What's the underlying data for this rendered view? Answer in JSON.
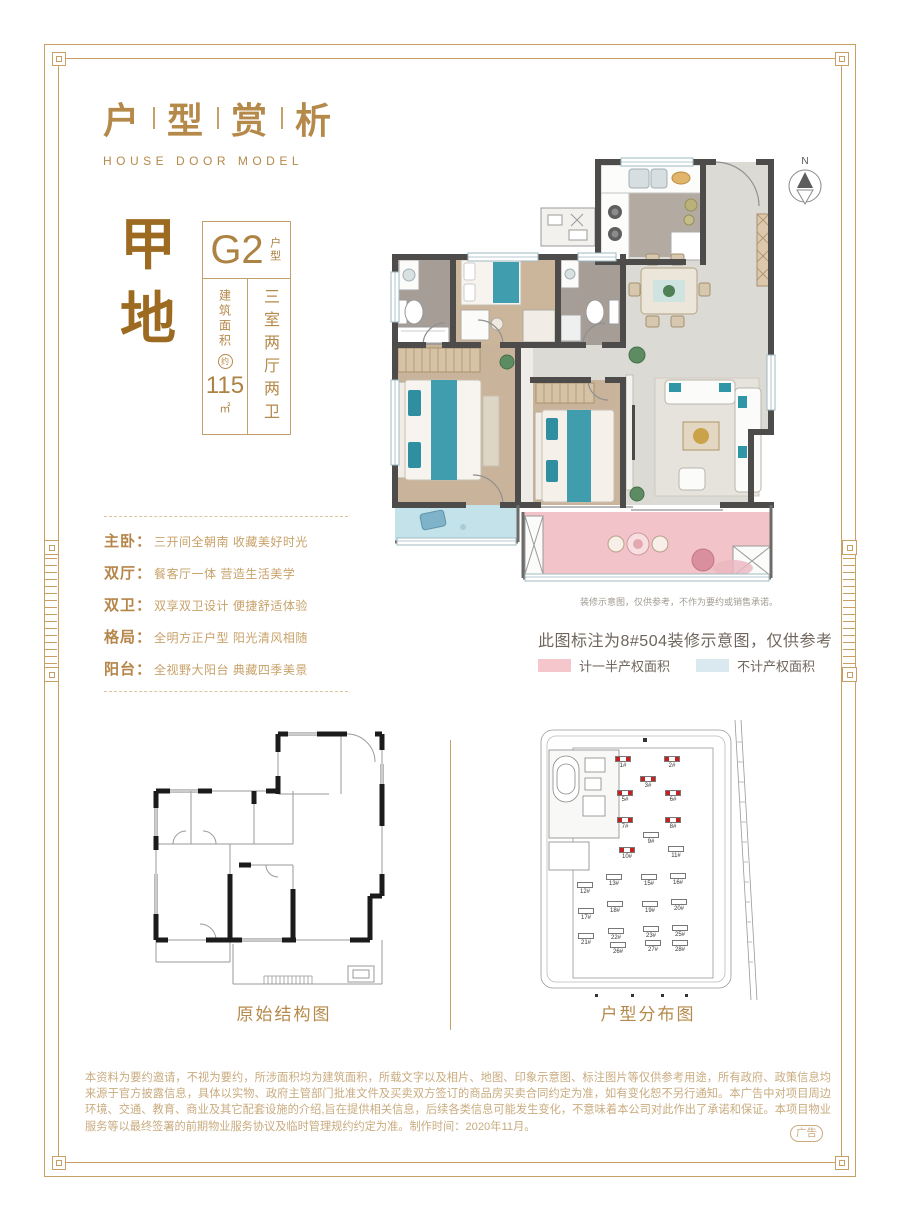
{
  "page": {
    "title_chars": [
      "户",
      "型",
      "赏",
      "析"
    ],
    "title_en": "HOUSE DOOR MODEL",
    "ad_badge": "广告"
  },
  "unit": {
    "plot_name": "甲地",
    "code": "G2",
    "code_suffix": "户型",
    "area_label": "建筑面积",
    "area_approx": "约",
    "area_value": "115",
    "area_unit": "㎡",
    "layout": "三室两厅两卫"
  },
  "features": [
    {
      "label": "主卧：",
      "desc": "三开间全朝南 收藏美好时光"
    },
    {
      "label": "双厅：",
      "desc": "餐客厅一体 营造生活美学"
    },
    {
      "label": "双卫：",
      "desc": "双享双卫设计 便捷舒适体验"
    },
    {
      "label": "格局：",
      "desc": "全明方正户型 阳光清风相随"
    },
    {
      "label": "阳台：",
      "desc": "全视野大阳台 典藏四季美景"
    }
  ],
  "floorplan": {
    "compass_label": "N",
    "caption_small": "装修示意图，仅供参考，不作为要约或销售承诺。",
    "note": "此图标注为8#504装修示意图，仅供参考",
    "legend": [
      {
        "label": "计一半产权面积",
        "color": "#f5c6cb"
      },
      {
        "label": "不计产权面积",
        "color": "#d9e9ef"
      }
    ]
  },
  "diagrams": {
    "structure_label": "原始结构图",
    "distribution_label": "户型分布图",
    "site_buildings": [
      {
        "label": "1#",
        "highlight": true
      },
      {
        "label": "2#",
        "highlight": true
      },
      {
        "label": "3#",
        "highlight": true
      },
      {
        "label": "5#",
        "highlight": true
      },
      {
        "label": "6#",
        "highlight": true
      },
      {
        "label": "7#",
        "highlight": true
      },
      {
        "label": "8#",
        "highlight": true
      },
      {
        "label": "9#",
        "highlight": false
      },
      {
        "label": "10#",
        "highlight": true
      },
      {
        "label": "11#",
        "highlight": false
      },
      {
        "label": "12#",
        "highlight": false
      },
      {
        "label": "13#",
        "highlight": false
      },
      {
        "label": "15#",
        "highlight": false
      },
      {
        "label": "16#",
        "highlight": false
      },
      {
        "label": "17#",
        "highlight": false
      },
      {
        "label": "18#",
        "highlight": false
      },
      {
        "label": "19#",
        "highlight": false
      },
      {
        "label": "20#",
        "highlight": false
      },
      {
        "label": "21#",
        "highlight": false
      },
      {
        "label": "22#",
        "highlight": false
      },
      {
        "label": "23#",
        "highlight": false
      },
      {
        "label": "25#",
        "highlight": false
      },
      {
        "label": "26#",
        "highlight": false
      },
      {
        "label": "27#",
        "highlight": false
      },
      {
        "label": "28#",
        "highlight": false
      }
    ]
  },
  "disclaimer": "本资料为要约邀请，不视为要约，所涉面积均为建筑面积，所载文字以及相片、地图、印象示意图、标注图片等仅供参考用途，所有政府、政策信息均来源于官方披露信息，具体以实物、政府主管部门批准文件及买卖双方签订的商品房买卖合同约定为准，如有变化恕不另行通知。本广告中对项目周边环境、交通、教育、商业及其它配套设施的介绍,旨在提供相关信息，后续各类信息可能发生变化，不意味着本公司对此作出了承诺和保证。本项目物业服务等以最终签署的前期物业服务协议及临时管理规约约定为准。制作时间：2020年11月。",
  "colors": {
    "accent_gold": "#b5894a",
    "frame_gold": "#c9a063",
    "highlight_red": "#c42222",
    "balcony_half_right": "#f2c3c8",
    "balcony_no_right": "#c3e2ea"
  }
}
